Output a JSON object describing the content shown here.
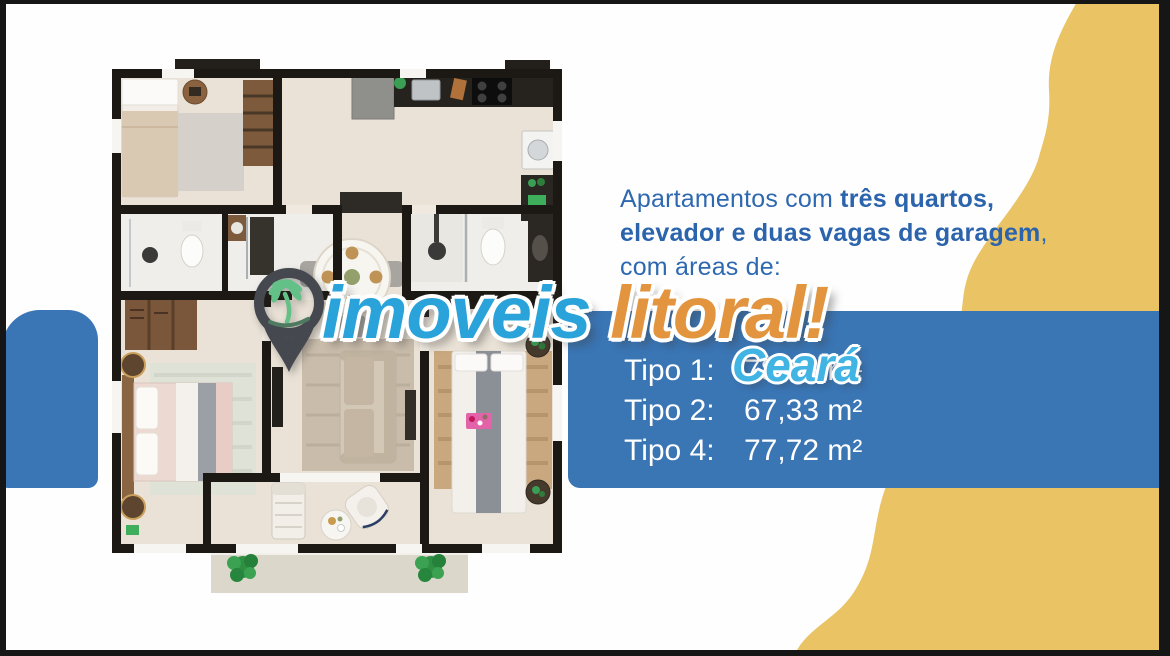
{
  "intro": {
    "line1_regular": "Apartamentos com ",
    "line1_bold": "três quartos,",
    "line2_bold": "elevador e duas vagas de garagem",
    "line2_regular": ",",
    "line3": "com áreas de:"
  },
  "types": {
    "rows": [
      {
        "label": "Tipo 1:",
        "area": "78,85 m²"
      },
      {
        "label": "Tipo 2:",
        "area": "67,33 m²"
      },
      {
        "label": "Tipo 4:",
        "area": "77,72 m²"
      }
    ]
  },
  "watermark": {
    "brand_first": "imoveis",
    "brand_second": "litoral!",
    "region": "Ceará",
    "pin_icon": "map-pin-with-palm-tree"
  },
  "colors": {
    "panel_blue": "#3a75b4",
    "accent_yellow": "#e9c364",
    "heading_blue": "#2d68b0",
    "watermark_cyan": "#2aa3da",
    "watermark_orange": "#e2953e",
    "watermark_region_cyan": "#41b4e4",
    "pin_gray": "#45494f",
    "palm_green": "#63c188",
    "wall_black": "#1c1813",
    "floor_beige": "#eae2d6"
  }
}
